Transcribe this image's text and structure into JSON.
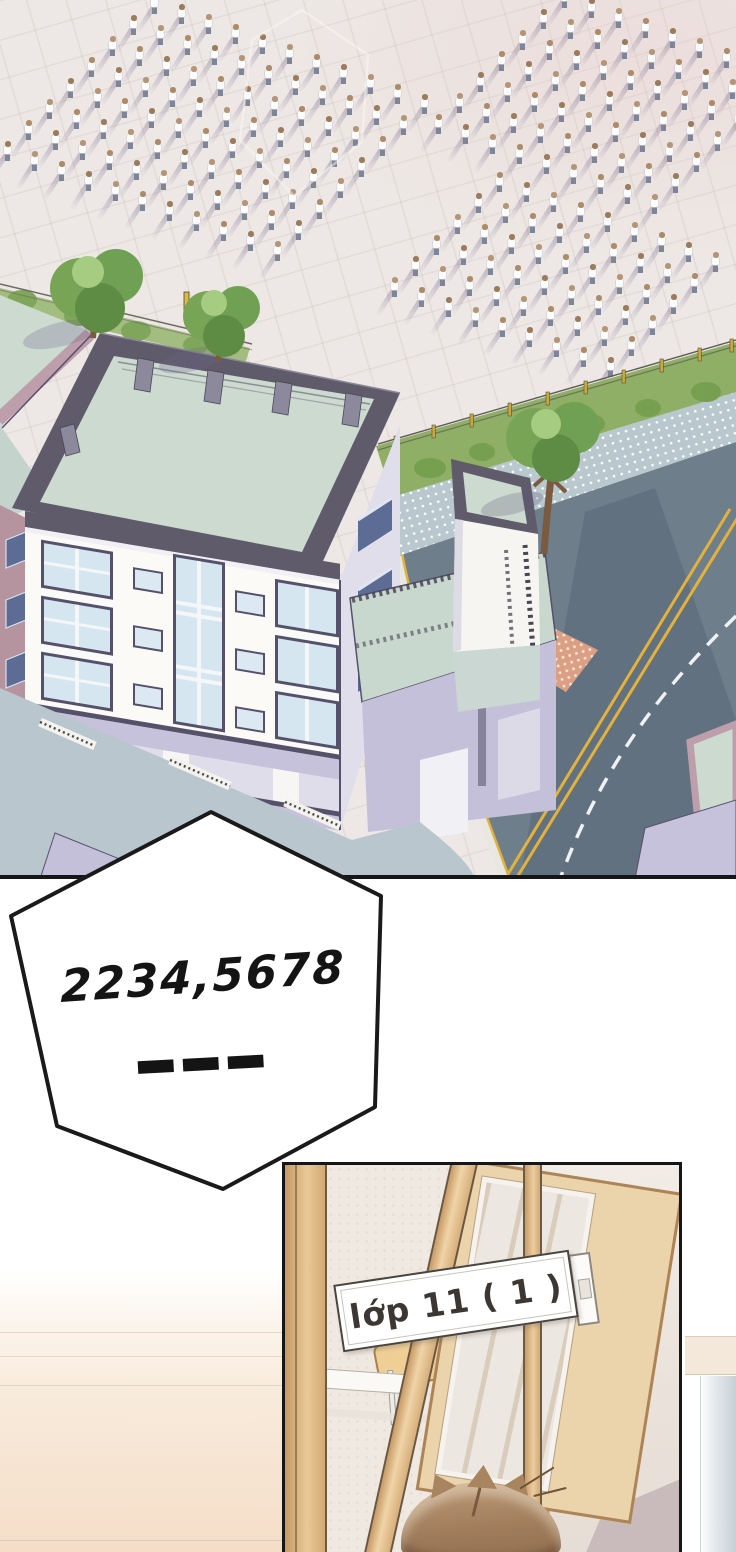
{
  "speech_bubble": {
    "line1": "2234,5678",
    "line2": "———"
  },
  "classroom_panel": {
    "door_sign_label": "lớp 11 ( 1 )"
  },
  "palette": {
    "pavement": "#EDE8E5",
    "road": "#6F7E8B",
    "sidewalk": "#B9C8CE",
    "hedge": "#8FAE66",
    "roofGreen": "#CCDAD0",
    "frame": "#5F5B6B",
    "frameLight": "#8D899C",
    "facade": "#FBFAF7",
    "windowGlass": "#D6E6F1",
    "windowFrame": "#55516A",
    "lavender": "#C6C2DB",
    "mauve": "#B5939F",
    "terrace": "#B9C6CE",
    "yellowLine": "#E2B23C",
    "crosswalk": "#DC9F83",
    "treeGreen": "#78A455",
    "treeTrunk": "#7A5B3F",
    "crowdShirt": "#FCFCFC",
    "crowdPants": "#7E8597",
    "crowdHead": "#AD8A68",
    "crowdShadow": "rgba(122,108,142,0.42)",
    "bubbleFill": "#FFFFFF",
    "bubbleStroke": "#1A1A1A",
    "inkText": "#141414",
    "signText": "#3D3733",
    "wood": "#E9C995",
    "hairBrown": "#A07C5B"
  },
  "scene": {
    "crowd_groups": [
      {
        "x": 150,
        "y": -6,
        "cols": 11,
        "rows": 8,
        "col_dx": 27,
        "col_dy": 10,
        "row_dx": -21,
        "row_dy": 21
      },
      {
        "x": 560,
        "y": -12,
        "cols": 9,
        "rows": 7,
        "col_dx": 27,
        "col_dy": 10,
        "row_dx": -21,
        "row_dy": 21
      },
      {
        "x": 495,
        "y": 172,
        "cols": 9,
        "rows": 6,
        "col_dx": 27,
        "col_dy": 10,
        "row_dx": -21,
        "row_dy": 21
      }
    ],
    "head_shades": [
      "#AD8A68",
      "#9C7B5C",
      "#B59577"
    ]
  }
}
